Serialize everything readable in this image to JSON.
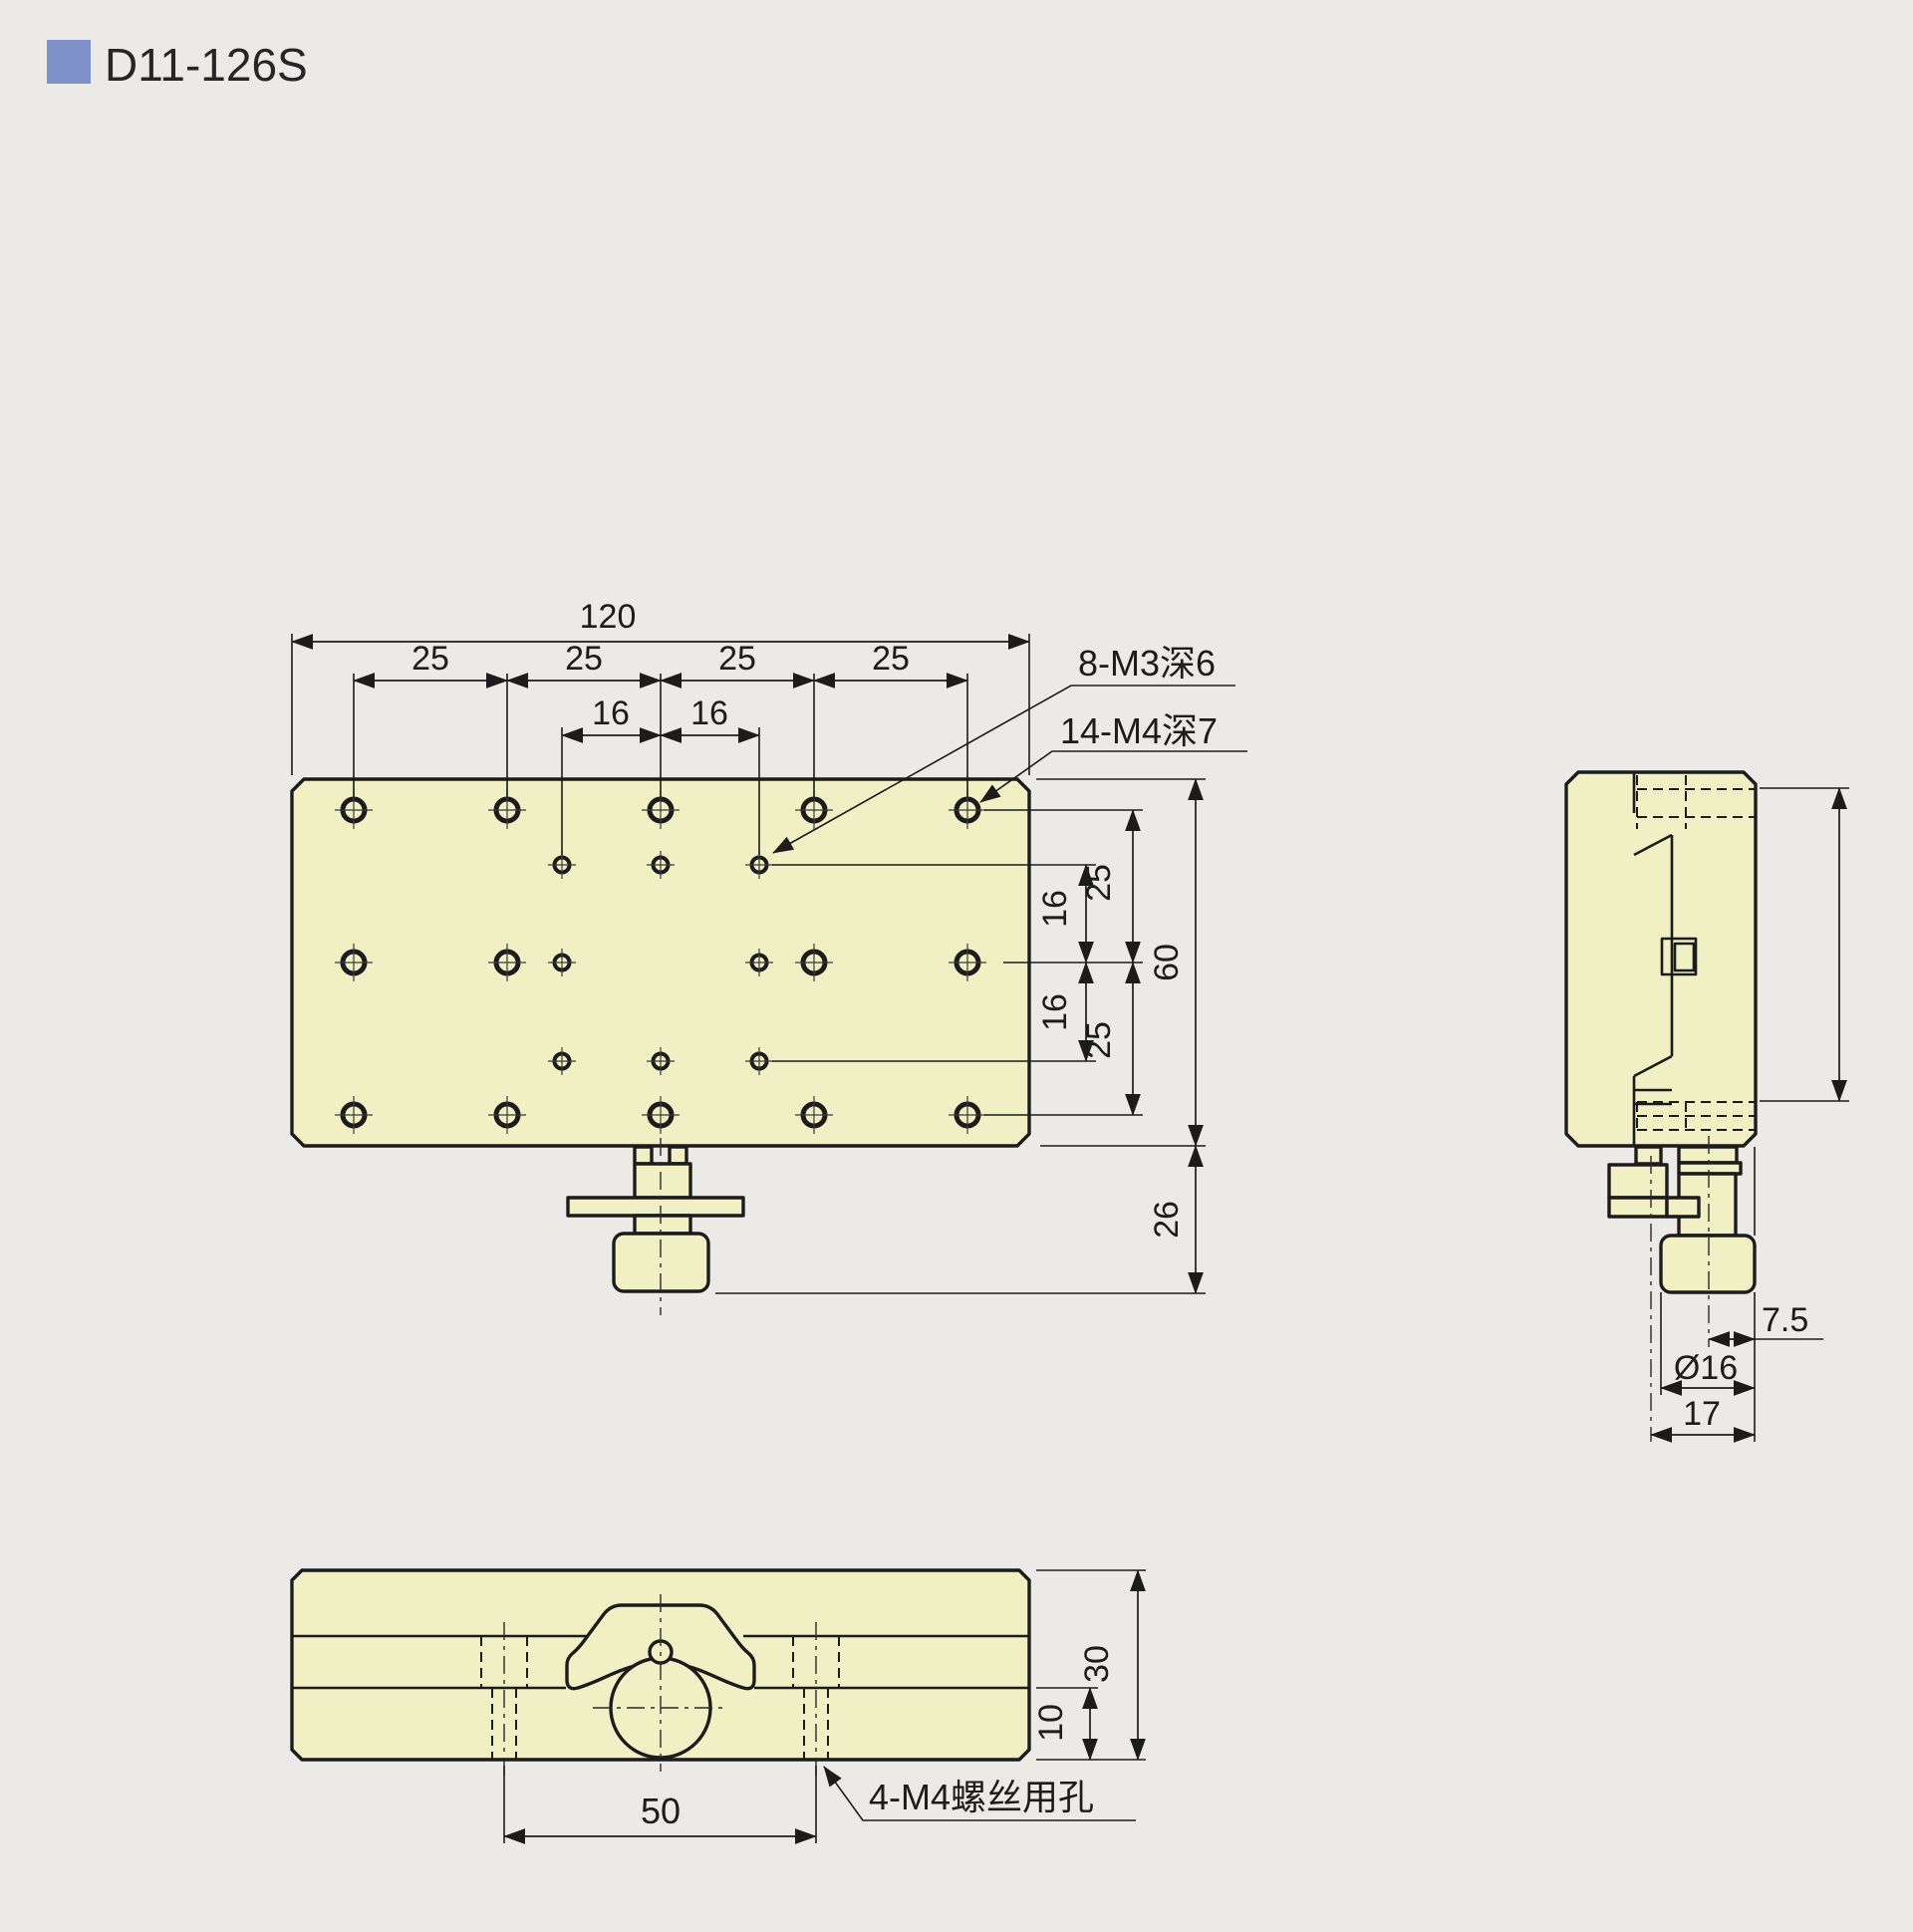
{
  "title": "D11-126S",
  "colors": {
    "part_fill": "#f1efc4",
    "background": "#eceae7",
    "line": "#1c1c1c",
    "accent_blue": "#7e91c8"
  },
  "top": {
    "w": "120",
    "p1": "25",
    "p2": "25",
    "p3": "25",
    "p4": "25",
    "s1": "16",
    "s2": "16",
    "u25": "25",
    "u16": "16",
    "l16": "16",
    "l25": "25",
    "h": "60",
    "k": "26",
    "m3": "8-M3深6",
    "m4": "14-M4深7"
  },
  "side": {
    "off": "7.5",
    "dia": "Ø16",
    "tot": "17"
  },
  "bottom": {
    "pitch": "50",
    "h": "30",
    "step": "10",
    "screw": "4-M4螺丝用孔"
  }
}
